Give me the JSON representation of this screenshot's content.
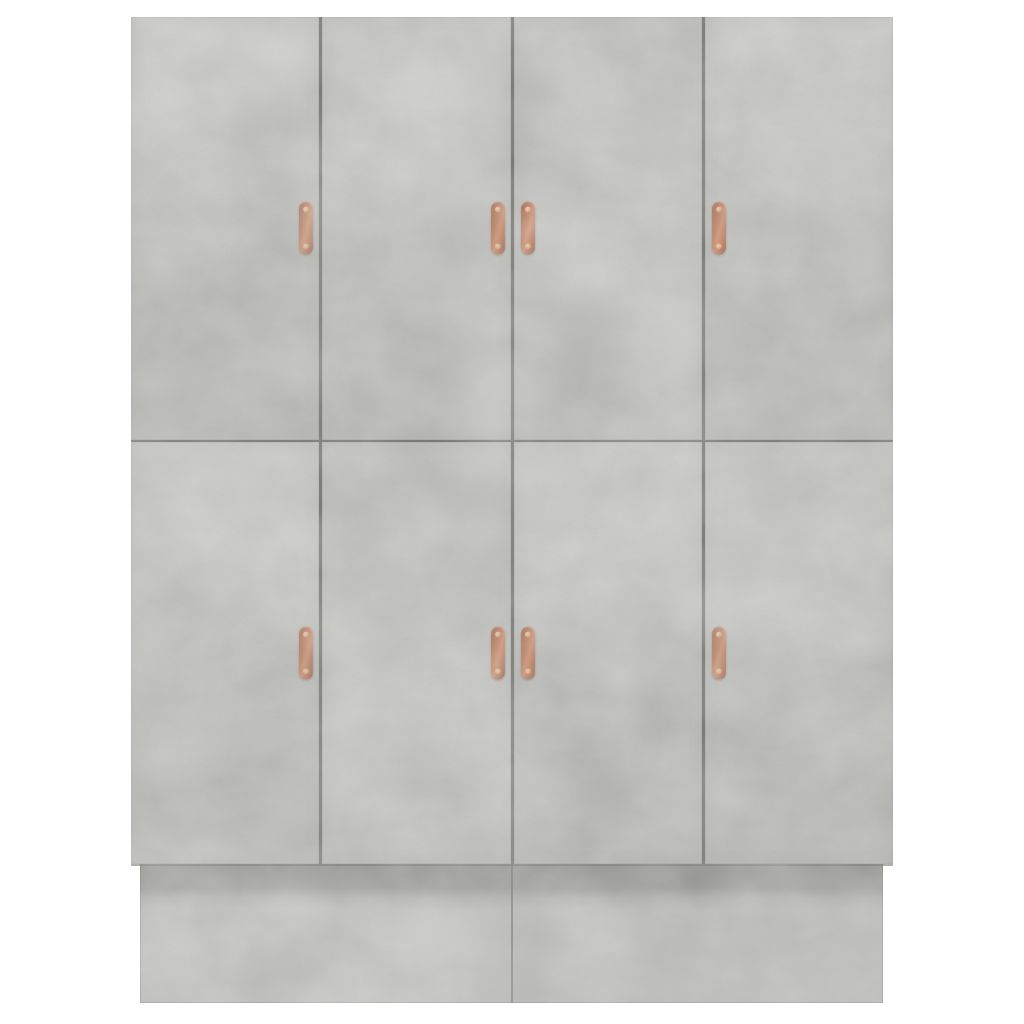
{
  "scene": {
    "type": "product-photo",
    "subject": "Eight-door wardrobe cabinet in concrete grey with copper pull handles on white background",
    "background_color": "#ffffff",
    "colors": {
      "cabinet_base": "#c2c3bf",
      "divider": "#6a6b67",
      "plinth_base": "#bfc0bc",
      "handle_body": "#bf7a5a",
      "handle_dark": "#9a5a3d",
      "handle_highlight": "#d08f6c",
      "screw": "#eccbb0"
    }
  },
  "cabinet": {
    "rows": 2,
    "columns": 4,
    "door_count": 8,
    "doors": [
      {
        "id": "door-top-1",
        "row": "top",
        "col": 1,
        "handle_side": "right",
        "texture_variant": "v1"
      },
      {
        "id": "door-top-2",
        "row": "top",
        "col": 2,
        "handle_side": "right",
        "texture_variant": "v2"
      },
      {
        "id": "door-top-3",
        "row": "top",
        "col": 3,
        "handle_side": "left",
        "texture_variant": "v3"
      },
      {
        "id": "door-top-4",
        "row": "top",
        "col": 4,
        "handle_side": "left",
        "texture_variant": "v4"
      },
      {
        "id": "door-bottom-1",
        "row": "bottom",
        "col": 1,
        "handle_side": "right",
        "texture_variant": "v5"
      },
      {
        "id": "door-bottom-2",
        "row": "bottom",
        "col": 2,
        "handle_side": "right",
        "texture_variant": "v6"
      },
      {
        "id": "door-bottom-3",
        "row": "bottom",
        "col": 3,
        "handle_side": "left",
        "texture_variant": "v7"
      },
      {
        "id": "door-bottom-4",
        "row": "bottom",
        "col": 4,
        "handle_side": "left",
        "texture_variant": "v8"
      }
    ],
    "handles_per_door": 1,
    "plinth": {
      "present": true,
      "inset_from_doors": true,
      "center_seam": true,
      "top_shadow_band": true
    }
  }
}
